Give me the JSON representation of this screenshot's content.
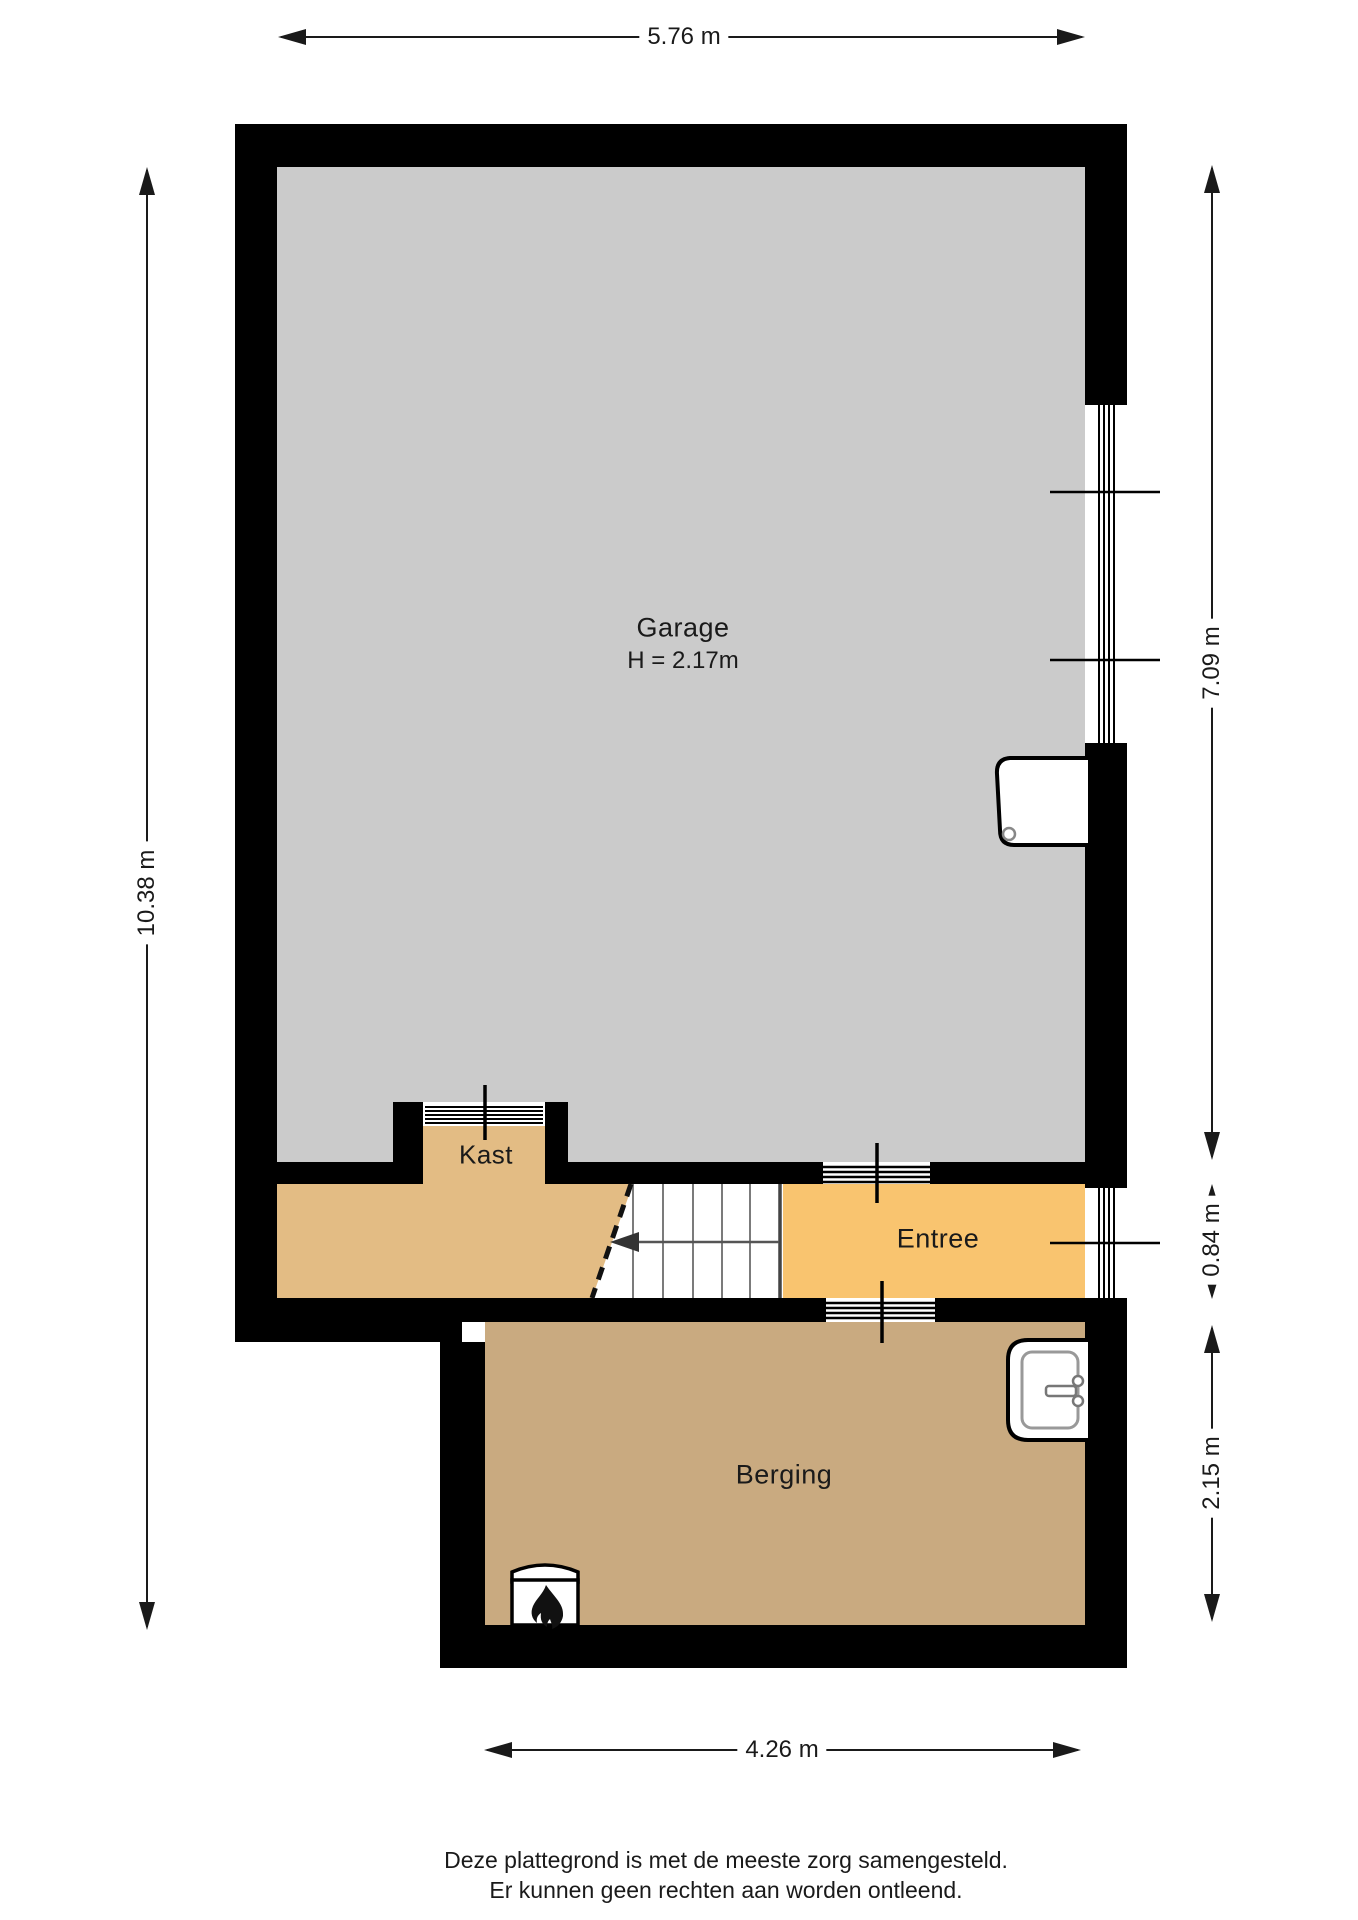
{
  "plan": {
    "type": "floorplan",
    "rooms": {
      "garage": {
        "name": "Garage",
        "height_note": "H = 2.17m"
      },
      "kast": {
        "name": "Kast"
      },
      "entree": {
        "name": "Entree"
      },
      "berging": {
        "name": "Berging"
      }
    },
    "dimensions": {
      "top_width": "5.76 m",
      "left_height": "10.38 m",
      "right_garage": "7.09 m",
      "right_entree": "0.84 m",
      "right_berging": "2.15 m",
      "bottom_width": "4.26 m"
    },
    "icons": {
      "boiler": "flame-icon",
      "sink": "sink-icon",
      "door": "door-leaf",
      "stair_direction": "arrow-left-icon"
    },
    "colors": {
      "wall": "#000000",
      "garage_floor": "#cbcbcb",
      "hall_floor": "#e3bc84",
      "kast_floor": "#e3bc84",
      "entree_floor": "#f9c46f",
      "berging_floor": "#c9aa80",
      "dimension_line": "#1a1a1a"
    }
  },
  "footer": {
    "line1": "Deze plattegrond is met de meeste zorg samengesteld.",
    "line2": "Er kunnen geen rechten aan worden ontleend."
  }
}
